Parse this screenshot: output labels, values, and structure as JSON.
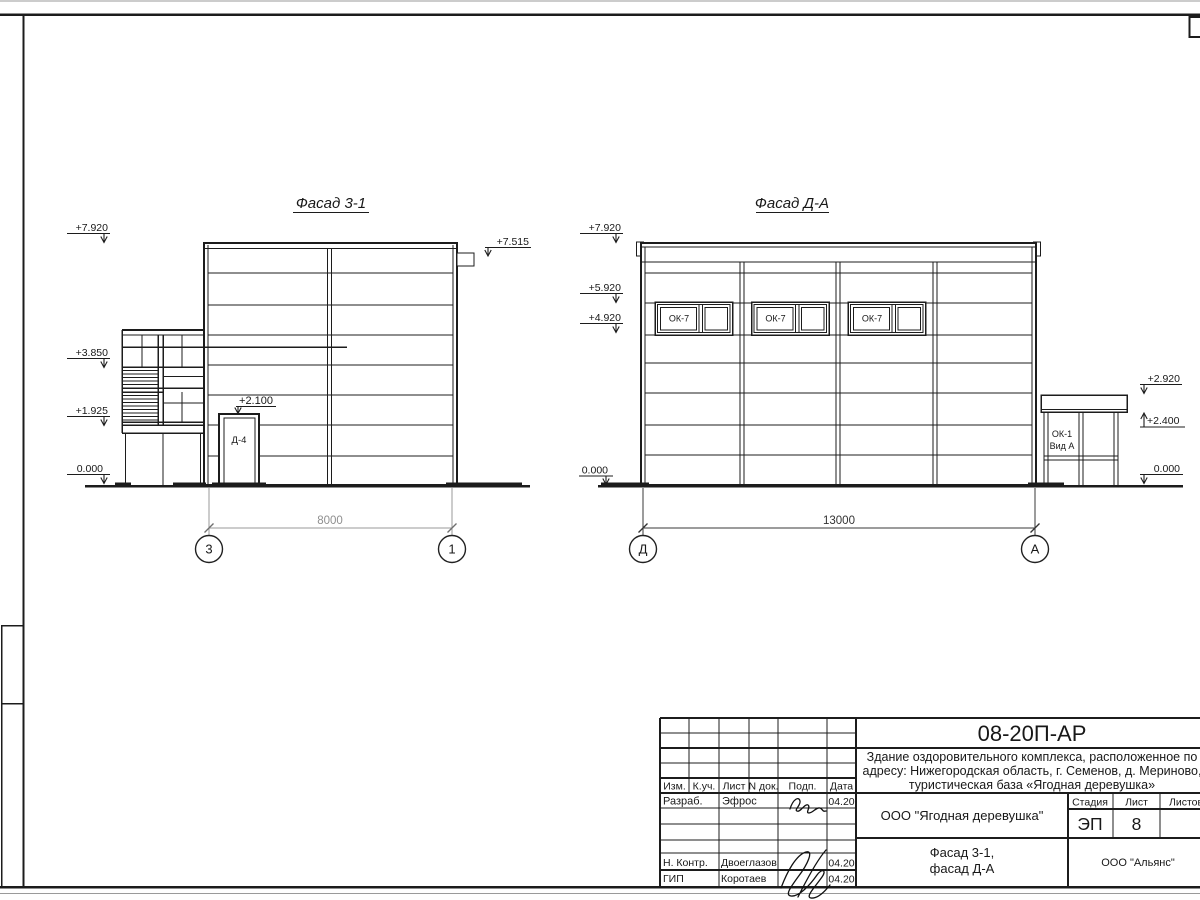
{
  "sheet": {
    "line_color": "#1c1c1c",
    "dim_gray": "#9a9a9a",
    "dim_dark": "#333333",
    "background": "#ffffff"
  },
  "facade_left": {
    "title": "Фасад 3-1",
    "marks": {
      "top": "+7.920",
      "annex": "+3.850",
      "mid": "+1.925",
      "zero": "0.000",
      "vent": "+7.515",
      "door": "+2.100"
    },
    "door_label": "Д-4",
    "dim": "8000",
    "axes": {
      "left": "3",
      "right": "1"
    }
  },
  "facade_right": {
    "title": "Фасад Д-А",
    "marks": {
      "top": "+7.920",
      "head": "+5.920",
      "sill": "+4.920",
      "zero_left": "0.000",
      "annex_top": "+2.920",
      "annex_soffit": "+2.400",
      "zero_right": "0.000"
    },
    "window_label": "ОК-7",
    "annex_label_line1": "ОК-1",
    "annex_label_line2": "Вид А",
    "dim": "13000",
    "axes": {
      "left": "Д",
      "right": "А"
    }
  },
  "titleblock": {
    "doc_number": "08-20П-АР",
    "project_lines": [
      "Здание оздоровительного комплекса, расположенное по",
      "адресу: Нижегородская область, г. Семенов, д. Мериново,",
      "туристическая база «Ягодная деревушка»"
    ],
    "client": "ООО \"Ягодная деревушка\"",
    "stage_label": "Стадия",
    "sheet_label": "Лист",
    "sheets_label": "Листов",
    "stage_value": "ЭП",
    "sheet_value": "8",
    "drawing_title_lines": [
      "Фасад 3-1,",
      "фасад Д-А"
    ],
    "company": "ООО \"Альянс\"",
    "header_cols": [
      "Изм.",
      "К.уч.",
      "Лист",
      "N док.",
      "Подп.",
      "Дата"
    ],
    "sign_rows": [
      {
        "label": "Разраб.",
        "name": "Эфрос",
        "date": "04.20"
      },
      {
        "label": "Н. Контр.",
        "name": "Двоеглазов",
        "date": "04.20"
      },
      {
        "label": "ГИП",
        "name": "Коротаев",
        "date": "04.20"
      }
    ]
  }
}
